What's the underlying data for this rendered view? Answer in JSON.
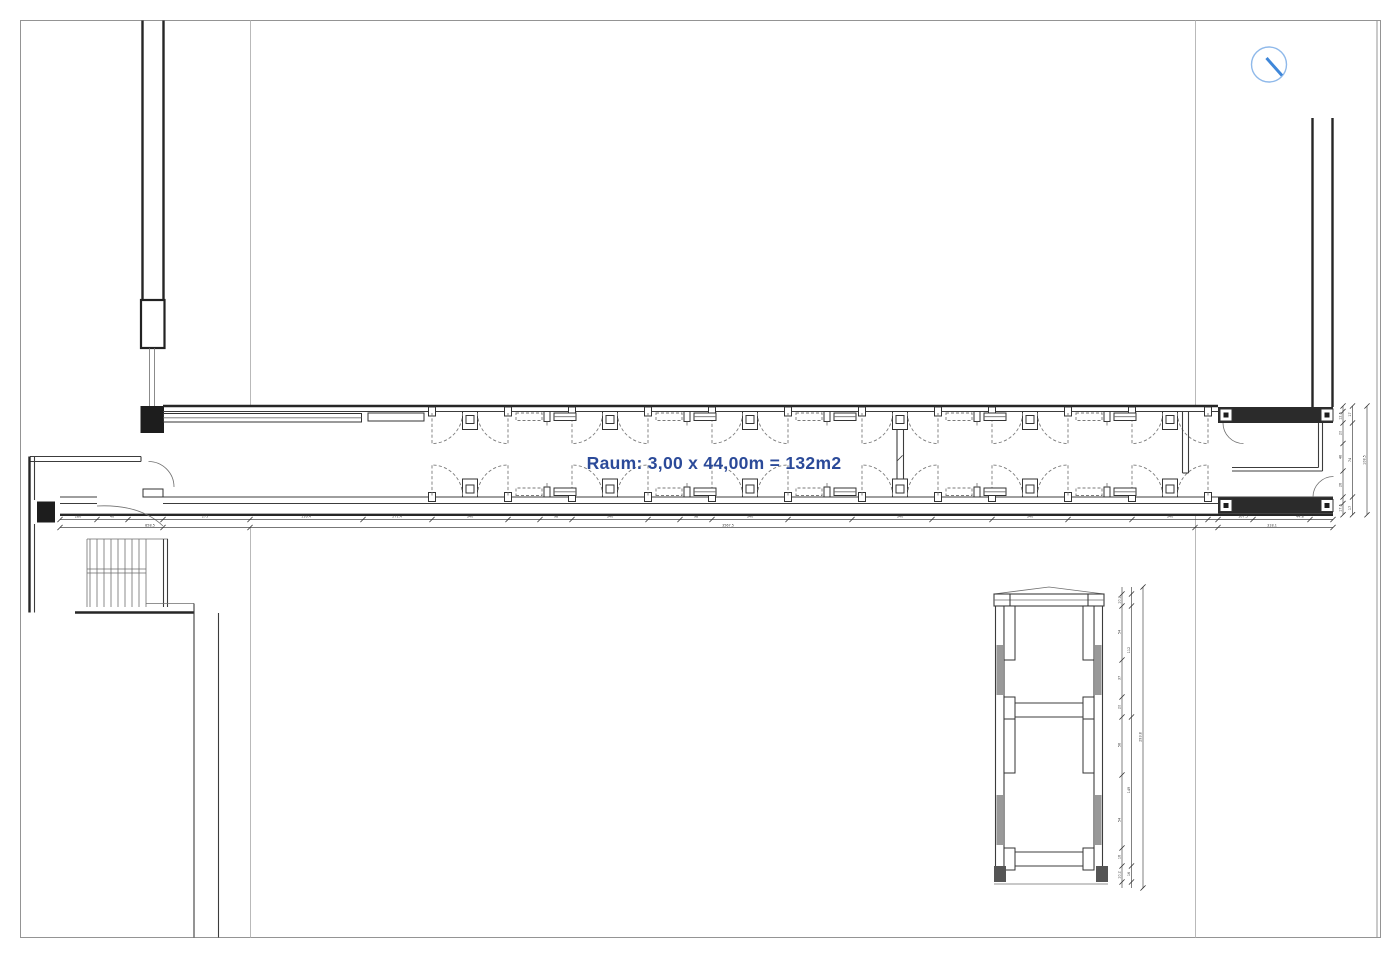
{
  "drawing": {
    "type": "architectural-floor-plan",
    "room_label": "Raum: 3,00 x 44,00m = 132m2"
  },
  "colors": {
    "accent_blue": "#2b4a99",
    "icon_circle_blue": "#8fb9ea",
    "icon_needle_blue": "#3f87d9",
    "wall_dark": "#262626",
    "grid_gray": "#b9b9b9",
    "poche_gray": "#999999"
  },
  "icons": {
    "north_indicator": "compass-needle-circle"
  },
  "dimensions": {
    "h1": [
      "280",
      "40",
      "275",
      "116.4",
      "271.4",
      "340",
      "98",
      "340",
      "98",
      "340",
      "340",
      "340",
      "340",
      "107.5",
      "44.8"
    ],
    "h2": [
      "858.5",
      "3567.5",
      "318.1"
    ],
    "r1": [
      "12.5",
      "20",
      "48",
      "26",
      "17.5"
    ],
    "r2": [
      "17",
      "74",
      "17"
    ],
    "r3": [
      "108.5"
    ],
    "t1": [
      "10.2",
      "54",
      "37",
      "20",
      "58",
      "54",
      "16",
      "10.2"
    ],
    "t2": [
      "112",
      "149",
      "16"
    ],
    "t3": [
      "293.8"
    ]
  }
}
